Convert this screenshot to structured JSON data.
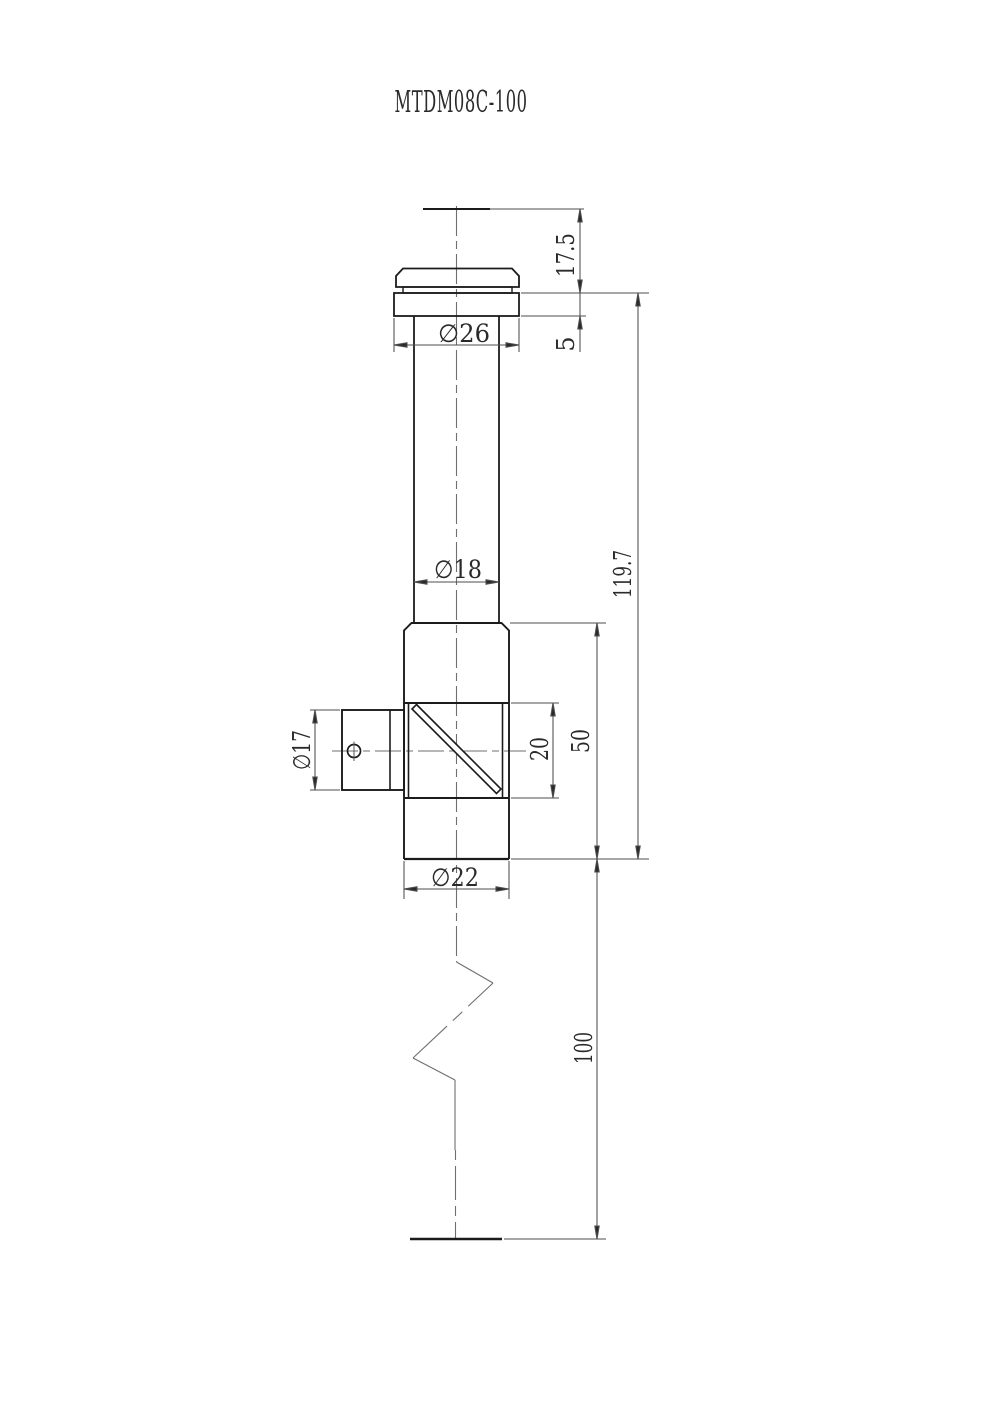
{
  "title": "MTDM08C-100",
  "dims": {
    "cap_height": "17.5",
    "flange_thickness": "5",
    "flange_dia": "∅26",
    "tube_dia": "∅18",
    "port_dia": "∅17",
    "window_len": "20",
    "body_len": "50",
    "overall_len": "119.7",
    "tail_len": "100",
    "body_dia": "∅22"
  },
  "colors": {
    "outline": "#1b1b1b",
    "dim_line": "#4d4d4d",
    "centerline": "#6f6f6f",
    "text": "#2a2a2a",
    "background": "#ffffff"
  }
}
